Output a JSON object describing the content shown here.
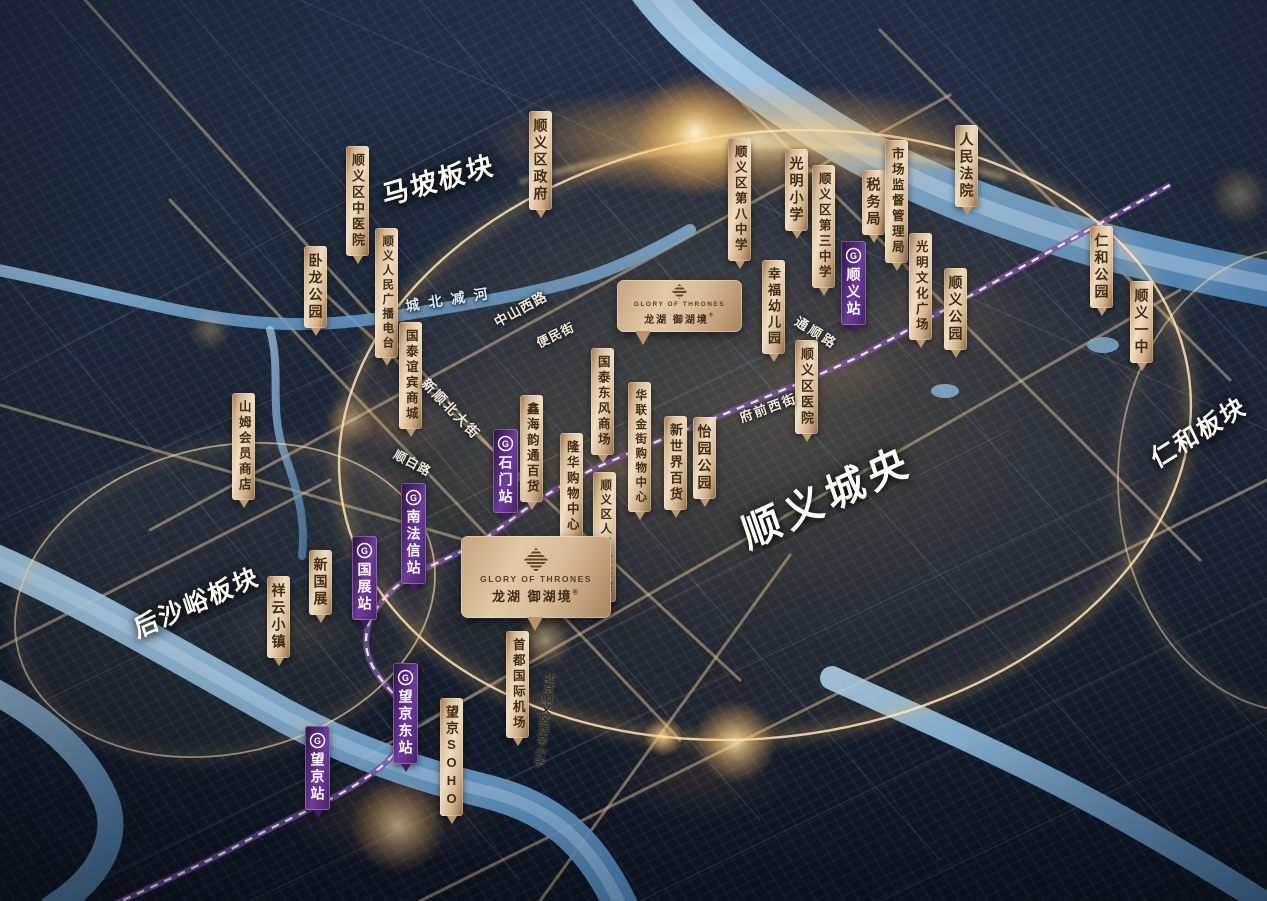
{
  "project": {
    "en": "GLORY OF THRONES",
    "cn": "龙湖 御湖境",
    "reg": "®"
  },
  "icons": {
    "metro_glyph": "G"
  },
  "colors": {
    "tag_tan": "#e6cda8",
    "tag_text": "#3f2c17",
    "metro_purple": "#5b2c7f",
    "ring_gold": "#ffd98e",
    "river_blue": "#7fb0d6",
    "night_base": "#1b2535"
  },
  "area_labels": [
    {
      "id": "mapo-plate",
      "text": "马坡板块",
      "x": 438,
      "y": 178,
      "rotate": -16,
      "fs": 27,
      "ls": 2
    },
    {
      "id": "houshayu-plate",
      "text": "后沙峪板块",
      "x": 196,
      "y": 601,
      "rotate": -24,
      "fs": 25,
      "ls": 2
    },
    {
      "id": "renhe-plate",
      "text": "仁和板块",
      "x": 1198,
      "y": 431,
      "rotate": -32,
      "fs": 25,
      "ls": 2
    },
    {
      "id": "shunyi-city-center",
      "text": "顺义城央",
      "x": 826,
      "y": 494,
      "rotate": -25,
      "fs": 40,
      "ls": 6
    }
  ],
  "poi_tags": [
    {
      "id": "shunyi-tcm-hospital",
      "text": "顺义区中医院",
      "x": 346,
      "y": 146,
      "fs": 13
    },
    {
      "id": "shunyi-district-government",
      "text": "顺义区政府",
      "x": 529,
      "y": 111,
      "fs": 14
    },
    {
      "id": "wolong-park",
      "text": "卧龙公园",
      "x": 304,
      "y": 246,
      "fs": 14
    },
    {
      "id": "shunyi-radio-station",
      "text": "顺义人民广播电台",
      "x": 375,
      "y": 228,
      "fs": 11.5
    },
    {
      "id": "guotai-yibin-mall",
      "text": "国泰谊宾商城",
      "x": 399,
      "y": 322,
      "fs": 12.5
    },
    {
      "id": "xinhai-yuntong-dept-store",
      "text": "鑫海韵通百货",
      "x": 520,
      "y": 395,
      "fs": 12.5
    },
    {
      "id": "guotai-dongfeng-mall",
      "text": "国泰东风商场",
      "x": 591,
      "y": 348,
      "fs": 12.5
    },
    {
      "id": "hualian-gold-street-mall",
      "text": "华联金街购物中心",
      "x": 628,
      "y": 382,
      "fs": 11.5
    },
    {
      "id": "longhua-shopping-center",
      "text": "隆华购物中心",
      "x": 560,
      "y": 433,
      "fs": 12.5
    },
    {
      "id": "shunyi-procuratorate",
      "text": "顺义区人民检察院",
      "x": 593,
      "y": 472,
      "fs": 11.5
    },
    {
      "id": "new-world-dept-store",
      "text": "新世界百货",
      "x": 664,
      "y": 416,
      "fs": 13
    },
    {
      "id": "yiyuan-park",
      "text": "怡园公园",
      "x": 693,
      "y": 417,
      "fs": 14
    },
    {
      "id": "shunyi-no8-middle-school",
      "text": "顺义区第八中学",
      "x": 728,
      "y": 138,
      "fs": 12.5
    },
    {
      "id": "guangming-primary-school",
      "text": "光明小学",
      "x": 785,
      "y": 149,
      "fs": 14
    },
    {
      "id": "shunyi-no3-middle-school",
      "text": "顺义区第三中学",
      "x": 812,
      "y": 165,
      "fs": 12.5
    },
    {
      "id": "tax-bureau",
      "text": "税务局",
      "x": 862,
      "y": 170,
      "fs": 14
    },
    {
      "id": "market-supervision-bureau",
      "text": "市场监督管理局",
      "x": 885,
      "y": 140,
      "fs": 12.5
    },
    {
      "id": "people-court",
      "text": "人民法院",
      "x": 955,
      "y": 125,
      "fs": 14
    },
    {
      "id": "xingfu-kindergarten",
      "text": "幸福幼儿园",
      "x": 762,
      "y": 260,
      "fs": 13
    },
    {
      "id": "guangming-culture-plaza",
      "text": "光明文化广场",
      "x": 909,
      "y": 233,
      "fs": 12.5
    },
    {
      "id": "shunyi-park",
      "text": "顺义公园",
      "x": 944,
      "y": 268,
      "fs": 14
    },
    {
      "id": "renhe-park",
      "text": "仁和公园",
      "x": 1090,
      "y": 226,
      "fs": 14
    },
    {
      "id": "shunyi-no1-high-school",
      "text": "顺义一中",
      "x": 1130,
      "y": 281,
      "fs": 14
    },
    {
      "id": "shunyi-district-hospital",
      "text": "顺义区医院",
      "x": 795,
      "y": 340,
      "fs": 13
    },
    {
      "id": "sams-club",
      "text": "山姆会员商店",
      "x": 232,
      "y": 393,
      "fs": 12.5
    },
    {
      "id": "xiangyun-town",
      "text": "祥云小镇",
      "x": 267,
      "y": 576,
      "fs": 14
    },
    {
      "id": "new-cnec",
      "text": "新国展",
      "x": 309,
      "y": 550,
      "fs": 14
    },
    {
      "id": "wangjing-soho",
      "text": "望京SOHO",
      "x": 440,
      "y": 698,
      "fs": 13
    },
    {
      "id": "capital-airport",
      "text": "首都国际机场",
      "x": 506,
      "y": 631,
      "fs": 12.5
    }
  ],
  "metro_stations": [
    {
      "id": "shunyi-station",
      "text": "顺义站",
      "x": 841,
      "y": 241
    },
    {
      "id": "shimen-station",
      "text": "石门站",
      "x": 493,
      "y": 429
    },
    {
      "id": "nanfaxin-station",
      "text": "南法信站",
      "x": 401,
      "y": 483
    },
    {
      "id": "guozhan-station",
      "text": "国展站",
      "x": 352,
      "y": 536
    },
    {
      "id": "wangjing-east-station",
      "text": "望京东站",
      "x": 393,
      "y": 663
    },
    {
      "id": "wangjing-station",
      "text": "望京站",
      "x": 305,
      "y": 726
    }
  ],
  "road_labels": [
    {
      "id": "chengbei-jian-river-label",
      "text": "城北减河",
      "x": 451,
      "y": 299,
      "rotate": -9,
      "fs": 14,
      "ls": 9,
      "color": "#d9e9f4",
      "vertical": false
    },
    {
      "id": "zhongshan-west-road",
      "text": "中山西路",
      "x": 520,
      "y": 308,
      "rotate": -29,
      "fs": 13.5,
      "ls": 1,
      "color": "#f2e8d8",
      "vertical": false
    },
    {
      "id": "bianmin-street",
      "text": "便民街",
      "x": 555,
      "y": 334,
      "rotate": -26,
      "fs": 12.5,
      "ls": 1,
      "color": "#f2e8d8",
      "vertical": false
    },
    {
      "id": "xinshun-north-street",
      "text": "新顺北大街",
      "x": 452,
      "y": 408,
      "rotate": 46,
      "fs": 13.5,
      "ls": 2,
      "color": "#f2e8d8",
      "vertical": false
    },
    {
      "id": "shunbai-road",
      "text": "顺白路",
      "x": 413,
      "y": 462,
      "rotate": 28,
      "fs": 12.5,
      "ls": 1,
      "color": "#f2e8d8",
      "vertical": false
    },
    {
      "id": "tongshun-road",
      "text": "通顺路",
      "x": 817,
      "y": 332,
      "rotate": 32,
      "fs": 13,
      "ls": 3,
      "color": "#f2e8d8",
      "vertical": false
    },
    {
      "id": "fuqian-west-street",
      "text": "府前西街",
      "x": 768,
      "y": 407,
      "rotate": -20,
      "fs": 13,
      "ls": 2,
      "color": "#f2e8d8",
      "vertical": false
    },
    {
      "id": "xixin-primary-school",
      "text": "北京顺义区西辛小学",
      "x": 545,
      "y": 719,
      "rotate": 7,
      "fs": 10.5,
      "ls": 0,
      "color": "#2f261b",
      "vertical": true
    }
  ],
  "plaques": [
    {
      "id": "project-plaque-north",
      "x": 617,
      "y": 280,
      "w": 125,
      "h": 52,
      "icon": 15,
      "en_fs": 6.5,
      "cn_fs": 10
    },
    {
      "id": "project-plaque-main",
      "x": 461,
      "y": 536,
      "w": 150,
      "h": 82,
      "icon": 24,
      "en_fs": 8.5,
      "cn_fs": 13
    }
  ]
}
